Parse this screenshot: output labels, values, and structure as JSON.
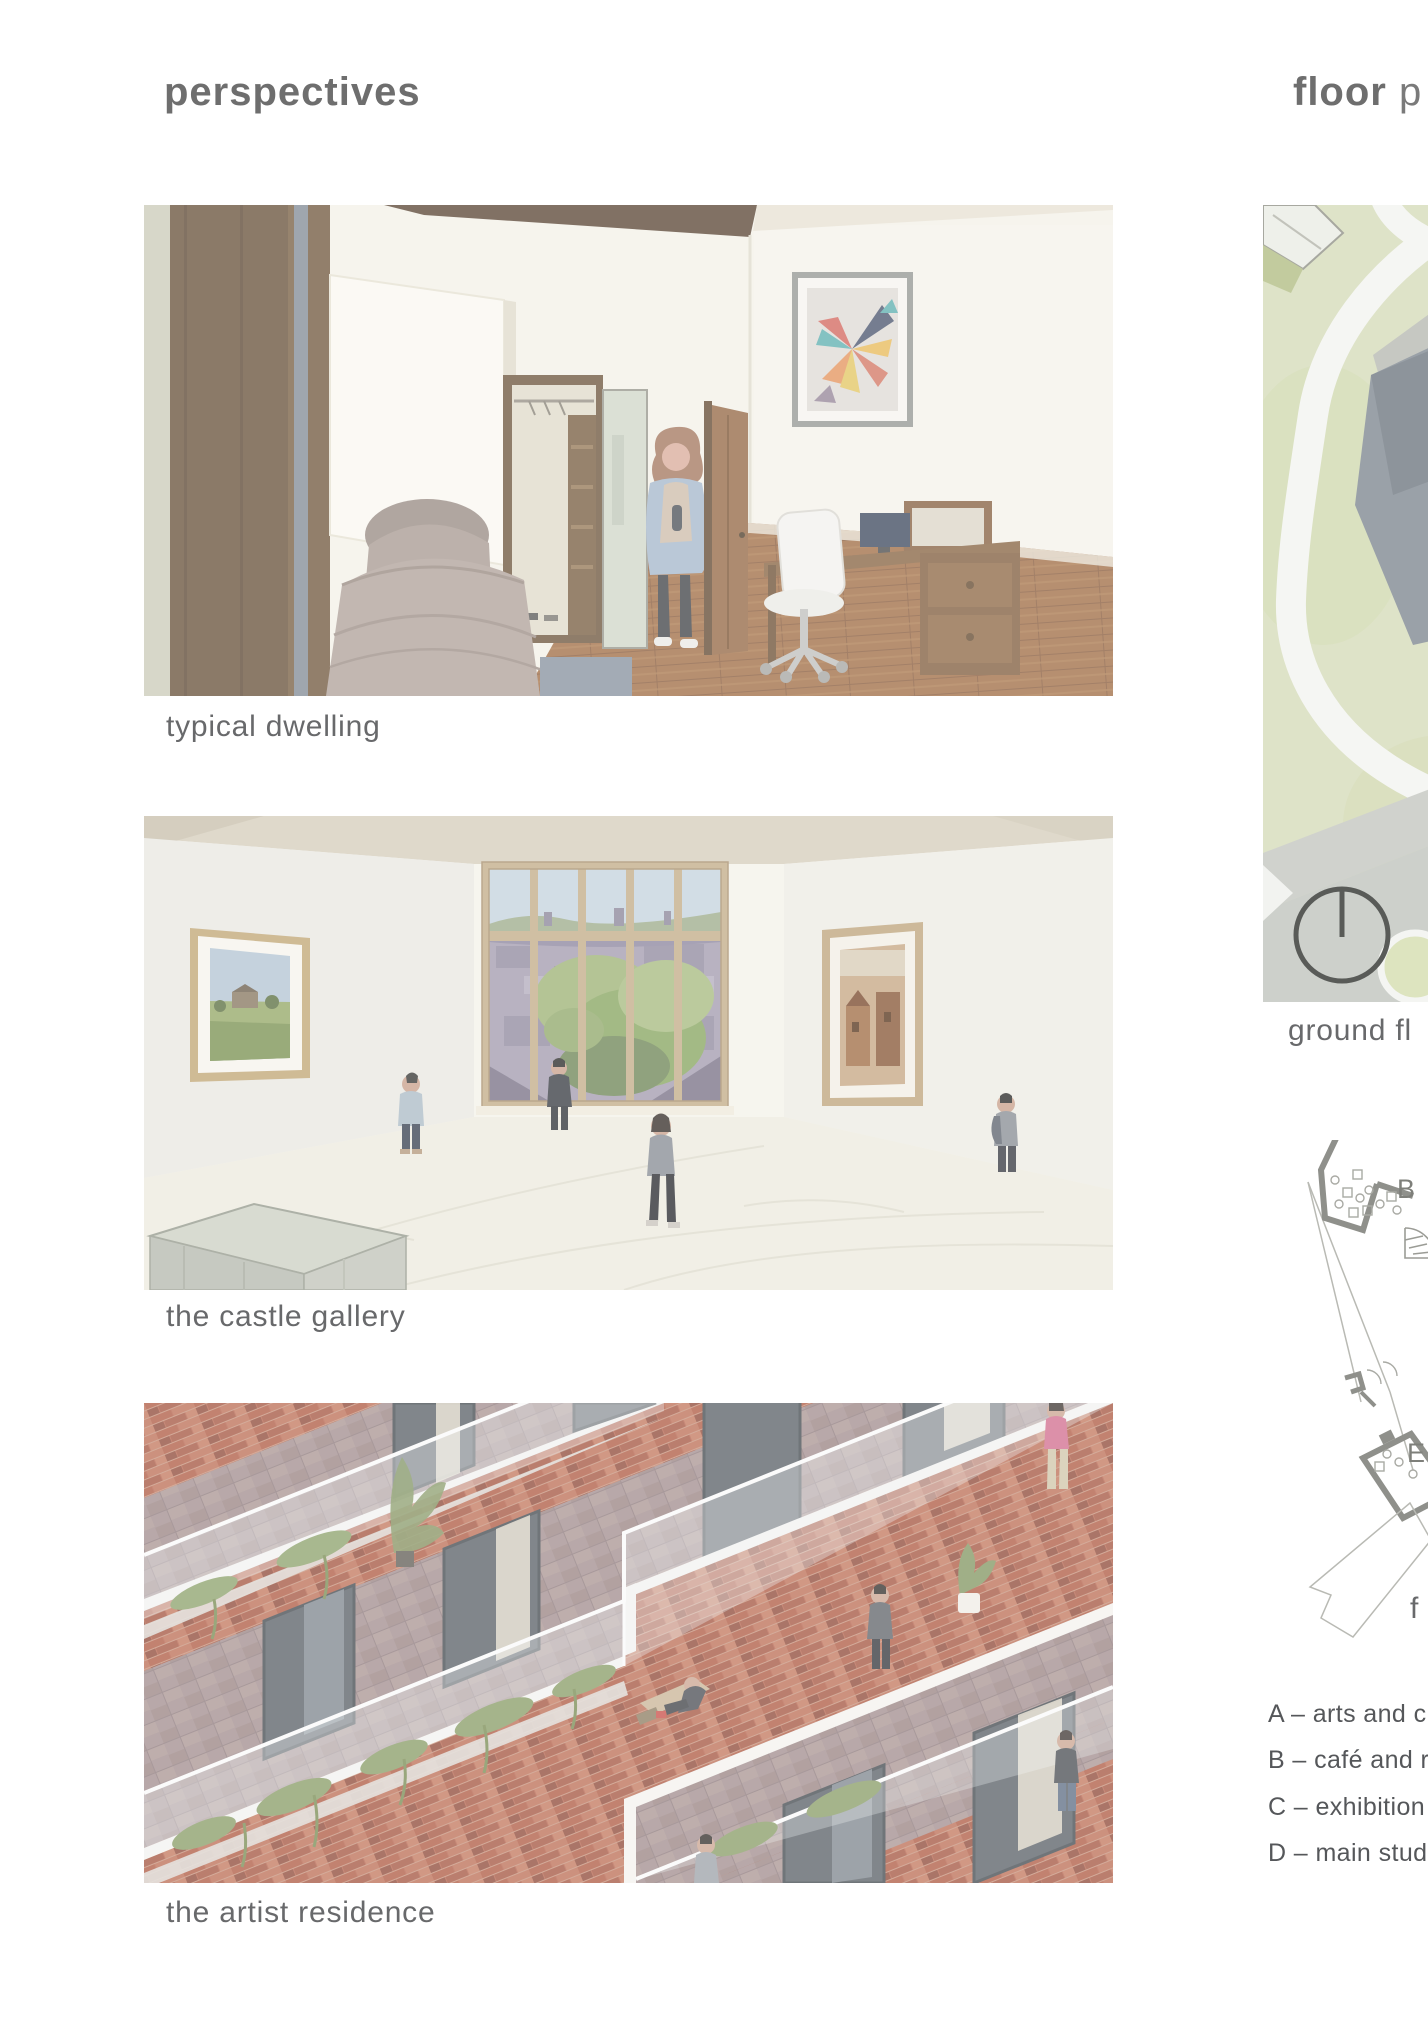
{
  "headers": {
    "perspectives": "perspectives",
    "floor_plans_bold": "floor",
    "floor_plans_rest": "p"
  },
  "perspectives": {
    "figures": [
      {
        "caption": "typical dwelling"
      },
      {
        "caption": "the castle gallery"
      },
      {
        "caption": "the artist residence"
      }
    ]
  },
  "plans": {
    "site_caption": "ground fl",
    "first_floor_caption": "f",
    "labels": {
      "b": "B",
      "e": "E"
    },
    "legend": [
      "A – arts and cr",
      "B – café and re",
      "C – exhibition s",
      "D – main studi"
    ]
  },
  "colors": {
    "heading_gray": "#6e6e6e",
    "caption_gray": "#68696b",
    "legend_gray": "#55575a",
    "site_green": "#dee3c8",
    "brick": "#b4614a",
    "plan_wall_gray": "#8f908b"
  }
}
